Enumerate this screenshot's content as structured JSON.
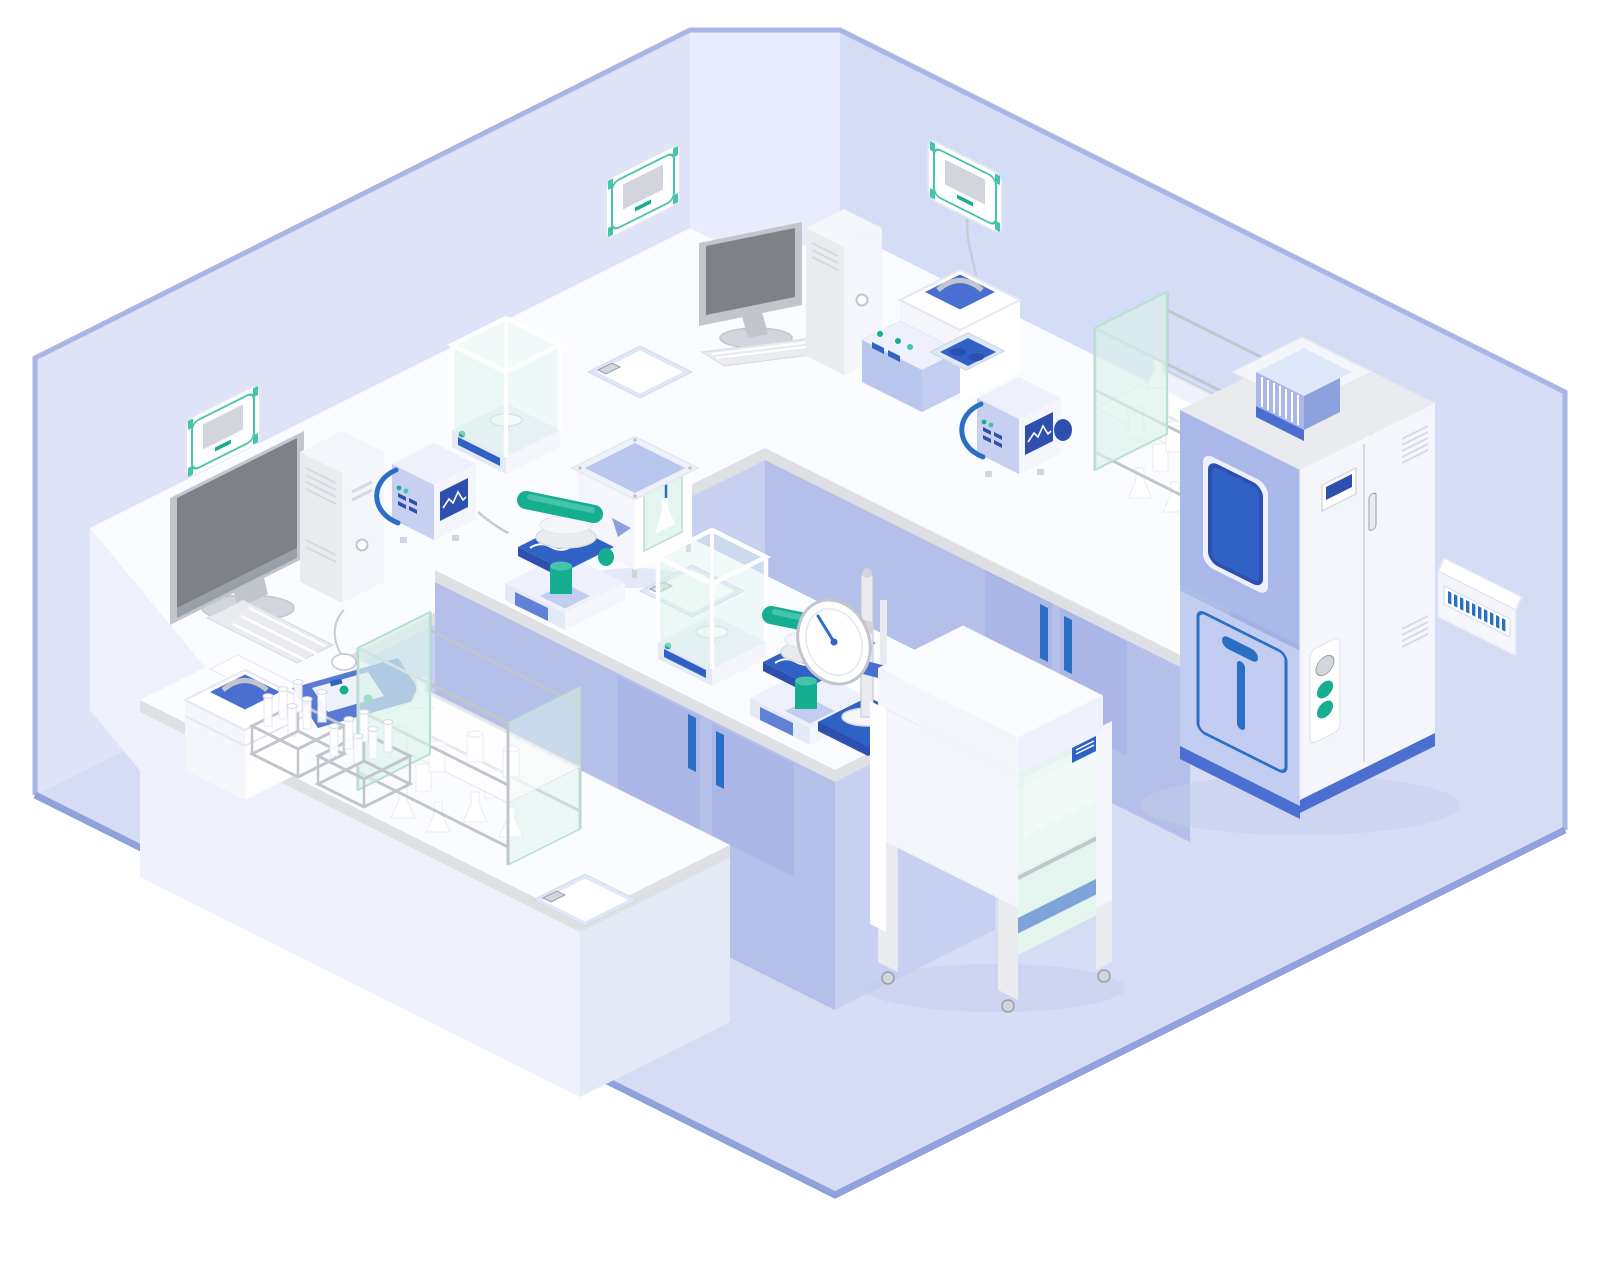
{
  "scene": {
    "type": "isometric-illustration",
    "subject": "laboratory room",
    "aria_label": "Isometric flat illustration of a laboratory: U-shaped lavender benches along two walls, a centre island bench with microscopes and balances, a laminar flow cabinet, an environmental test chamber, glassware shelves and wall-mounted control panels"
  },
  "palette": {
    "bg": "#ffffff",
    "wall_left": "#dee3f8",
    "wall_right": "#d5dcf5",
    "wall_corner": "#e9ecfc",
    "wall_edge": "#a9b5e6",
    "floor": "#d6dcf4",
    "floor_edge": "#8fa2de",
    "floor_shadow": "#c5cceb",
    "bench_top": "#fbfcff",
    "bench_edge": "#dfe0e3",
    "bench_front": "#eef1fb",
    "bench_side": "#e4e9f6",
    "cabinet_face": "#b4c0ea",
    "cabinet_door": "#a9b6e6",
    "cabinet_side": "#c7d0f0",
    "handle_blue": "#2a6fc4",
    "accent_blue": "#4a6fd0",
    "deep_blue": "#2d50b0",
    "royal_blue": "#2f62c4",
    "panel_blue": "#b9c6ee",
    "periwinkle": "#a9b8e8",
    "periwinkle_light": "#c3cdf1",
    "periwinkle_dark": "#8ca0de",
    "screen_blue": "#2e4fae",
    "teal": "#16ae90",
    "teal_light": "#45c4ab",
    "glass_mint": "#daf1ea",
    "glass_edge": "#b7e0d2",
    "glass_blue": "#dfe7fa",
    "metal": "#c2c5cc",
    "metal_dark": "#9aa0a8",
    "gray_screen": "#7e8287",
    "gray_light": "#e9ebef",
    "gray_mid": "#d2d5db",
    "machine_white": "#f4f6fb",
    "interior_mint": "#e4f4ef",
    "work_blue": "#7ea3d8",
    "cable": "#c6cbd8",
    "paper_blue": "#7189d6",
    "line_light": "#e4e7f0",
    "line_mid": "#d6d9e0",
    "white": "#ffffff"
  },
  "inventory": {
    "room": [
      "left wall",
      "right wall",
      "chamfered corner",
      "lavender floor"
    ],
    "wall_fixtures": [
      "wall control panel x4 (white, teal trim, grey screen, drop cables)",
      "circuit breaker panel with blue switches"
    ],
    "workstations": [
      "desktop computer with monitor, keyboard and mouse x2"
    ],
    "instruments": [
      "benchtop spectrum analyzer with blue handle and waveform screen x2",
      "analytical balance with glass draft shield x2",
      "microscope with teal arm and blue stage x2",
      "dial gauge test stand on blue base",
      "sample prep analyzer with blue control deck",
      "reagent chamber with blue lid and glass window",
      "environmental test chamber with viewing window and vent module",
      "laminar flow cabinet on castors"
    ],
    "labware": [
      "glass shelving unit with flasks and beakers x2",
      "test tube rack x2",
      "carrying case with recessed blue lid",
      "blue sample tray with teal vials",
      "clipboard x3",
      "loose papers"
    ]
  }
}
